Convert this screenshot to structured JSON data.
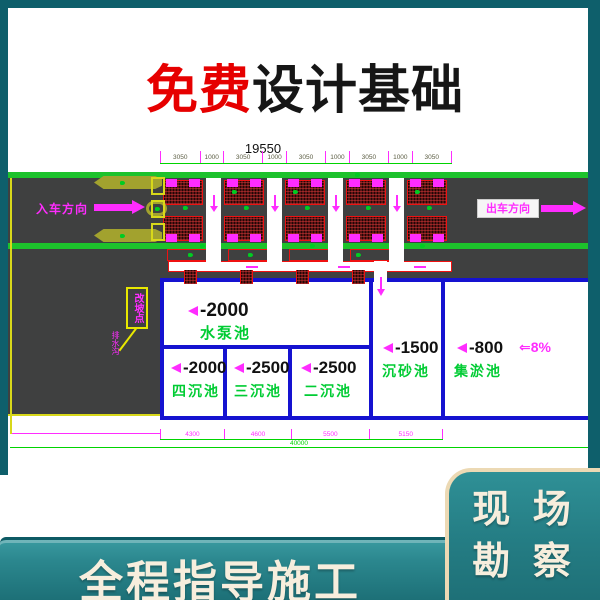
{
  "title": {
    "highlight": "免费",
    "rest": "设计基础"
  },
  "footer_banner": {
    "label": "全程指导施工"
  },
  "corner_badge": {
    "line1": "现 场",
    "line2": "勘 察"
  },
  "drawing": {
    "dims": {
      "total_top": "19550",
      "top_segments": [
        "3050",
        "1000",
        "3050",
        "1000",
        "3050",
        "1000",
        "3050",
        "1000",
        "3050"
      ],
      "bottom_segments": [
        "4300",
        "4600",
        "5500",
        "5150"
      ],
      "total_bottom": "40000"
    },
    "labels": {
      "entry": "入车方向",
      "exit": "出车方向",
      "slope": "⇐8%",
      "callout": "改坡点",
      "callout_small": "排水沟"
    },
    "pools": [
      {
        "level": "-2000",
        "name": "水泵池"
      },
      {
        "level": "-2000",
        "name": "四沉池"
      },
      {
        "level": "-2500",
        "name": "三沉池"
      },
      {
        "level": "-2500",
        "name": "二沉池"
      },
      {
        "level": "-1500",
        "name": "沉砂池"
      },
      {
        "level": "-800",
        "name": "集淤池"
      }
    ]
  },
  "colors": {
    "frame_teal": "#0e5f6b",
    "banner_teal": "#27858b",
    "cream": "#f7eedd",
    "title_red": "#e60000",
    "cad_green": "#00d400",
    "cad_magenta": "#ff2cff",
    "cad_blue": "#1512d0",
    "cad_red": "#ef1111",
    "road_gray": "#3f4040",
    "cad_yellow": "#e8e800",
    "label_green": "#00cc33"
  }
}
